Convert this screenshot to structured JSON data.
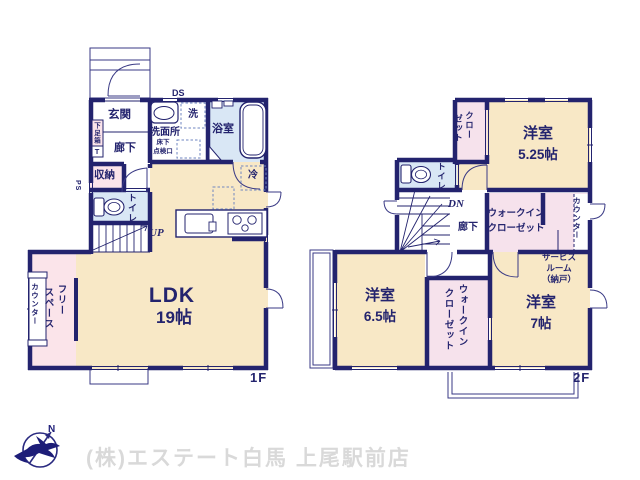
{
  "f1": {
    "label": "1F",
    "genkan": "玄関",
    "rouka": "廊下",
    "getabako": "下足箱",
    "getabako_t": "T",
    "ds": "DS",
    "ps": "PS",
    "senmenjo": "洗面所",
    "sen": "洗",
    "yukashita_l1": "床下",
    "yukashita_l2": "点検口",
    "yokushitsu": "浴室",
    "shuno": "収納",
    "toire": "トイレ",
    "up": "UP",
    "rei": "冷",
    "ldk": "LDK",
    "ldk_size": "19帖",
    "free_c1": "フリー",
    "free_c2": "スペース",
    "counter": "カウンター"
  },
  "f2": {
    "label": "2F",
    "closet_c1": "クロー",
    "closet_c2": "ゼット",
    "room525": "洋室",
    "room525_size": "5.25帖",
    "toire": "トイレ",
    "dn": "DN",
    "rouka": "廊下",
    "wic_l1": "ウォークイン",
    "wic_l2": "クローゼット",
    "service_l1": "サービス",
    "service_l2": "ルーム",
    "service_l3": "（納戸）",
    "counter": "カウンター",
    "room65": "洋室",
    "room65_size": "6.5帖",
    "wic2_c1": "ウォークイン",
    "wic2_c2": "クローゼット",
    "room7": "洋室",
    "room7_size": "7帖"
  },
  "footer": {
    "company": "(株)エステート白馬 上尾駅前店",
    "compass_n": "N"
  },
  "colors": {
    "wall": "#23236e",
    "room_beige": "#f8e8c6",
    "room_pink": "#fbe4ea",
    "room_pink2": "#f6e2ec",
    "room_blue": "#d9e7f5",
    "logo_text": "#d9d9d9"
  }
}
